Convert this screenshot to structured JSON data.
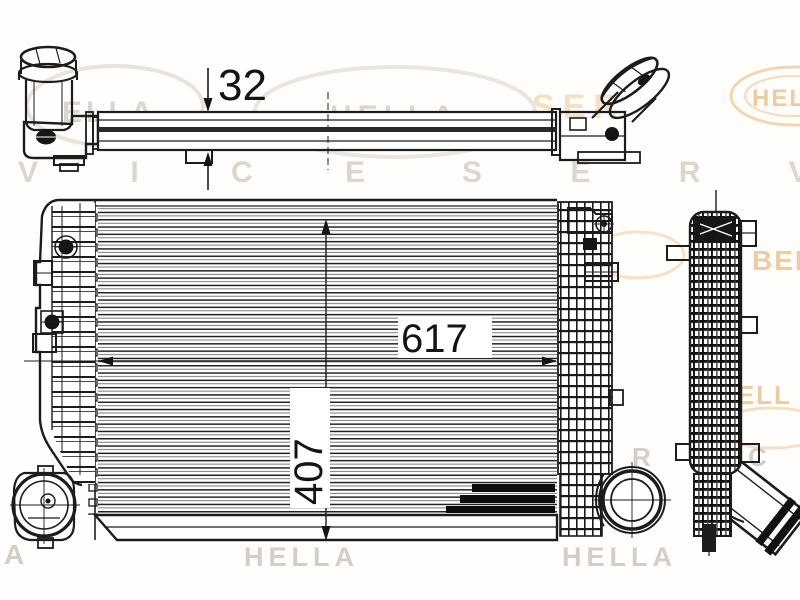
{
  "drawing": {
    "dimensions": {
      "thickness": "32",
      "width": "617",
      "height": "407"
    }
  },
  "watermark": {
    "logo_top_left": "ELLA",
    "logo_top_center": "HELLA",
    "ser_top": "SER",
    "logo_top_right": "HELLA",
    "service_row_left": "V I C E",
    "service_row_right": "S E R V I",
    "mid_left_logo": "HELLA",
    "mid_fragment": "ER",
    "mid_right_fragment": "BEH",
    "lower_right_fragment": "HELL",
    "letter_r": "R",
    "letter_c": "C",
    "bottom_left_fragment": "A",
    "bottom_center_logo": "HELLA",
    "bottom_right_logo": "HELLA"
  },
  "colors": {
    "ink": "#1c1c1c",
    "wm_gray": "#dad7d0",
    "wm_gray_dim": "#d2cfc8",
    "wm_orange": "#eccd9f",
    "wm_orange_light": "#f5e1c2",
    "paper": "#ffffff"
  }
}
